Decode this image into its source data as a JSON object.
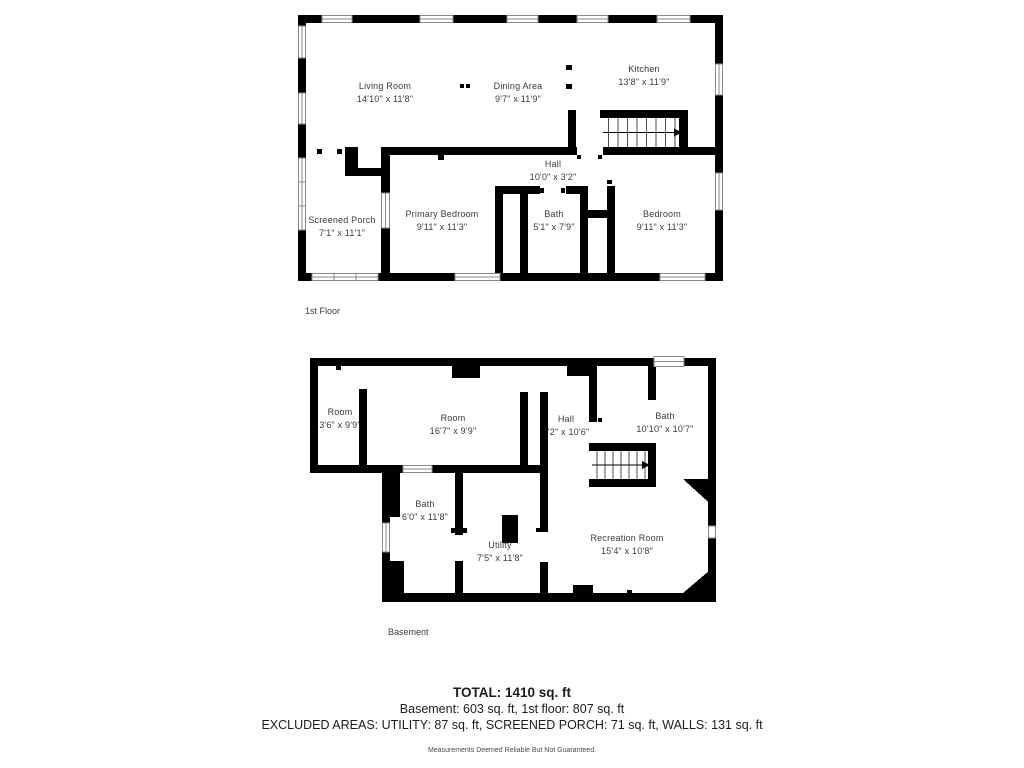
{
  "first_floor": {
    "label": "1st Floor",
    "rooms": [
      {
        "name": "Living Room",
        "dims": "14'10\" x 11'8\""
      },
      {
        "name": "Dining Area",
        "dims": "9'7\" x 11'9\""
      },
      {
        "name": "Kitchen",
        "dims": "13'8\" x 11'9\""
      },
      {
        "name": "Hall",
        "dims": "10'0\" x 3'2\""
      },
      {
        "name": "Screened Porch",
        "dims": "7'1\" x 11'1\""
      },
      {
        "name": "Primary Bedroom",
        "dims": "9'11\" x 11'3\""
      },
      {
        "name": "Bath",
        "dims": "5'1\" x 7'9\""
      },
      {
        "name": "Bedroom",
        "dims": "9'11\" x 11'3\""
      }
    ]
  },
  "basement": {
    "label": "Basement",
    "rooms": [
      {
        "name": "Room",
        "dims": "3'6\" x 9'9\""
      },
      {
        "name": "Room",
        "dims": "16'7\" x 9'9\""
      },
      {
        "name": "Hall",
        "dims": "4'2\" x 10'6\""
      },
      {
        "name": "Bath",
        "dims": "10'10\" x 10'7\""
      },
      {
        "name": "Bath",
        "dims": "6'0\" x 11'8\""
      },
      {
        "name": "Utility",
        "dims": "7'5\" x 11'8\""
      },
      {
        "name": "Recreation Room",
        "dims": "15'4\" x 10'8\""
      }
    ]
  },
  "summary": {
    "total": "TOTAL: 1410 sq. ft",
    "floors": "Basement: 603 sq. ft, 1st floor: 807 sq. ft",
    "excluded": "EXCLUDED AREAS: UTILITY: 87 sq. ft, SCREENED PORCH: 71 sq. ft, WALLS: 131 sq. ft",
    "disclaimer": "Measurements Deemed Reliable But Not Guaranteed."
  },
  "colors": {
    "wall": "#000000",
    "tread_line": "#4d4d4d",
    "window_frame": "#8a8a8a"
  }
}
